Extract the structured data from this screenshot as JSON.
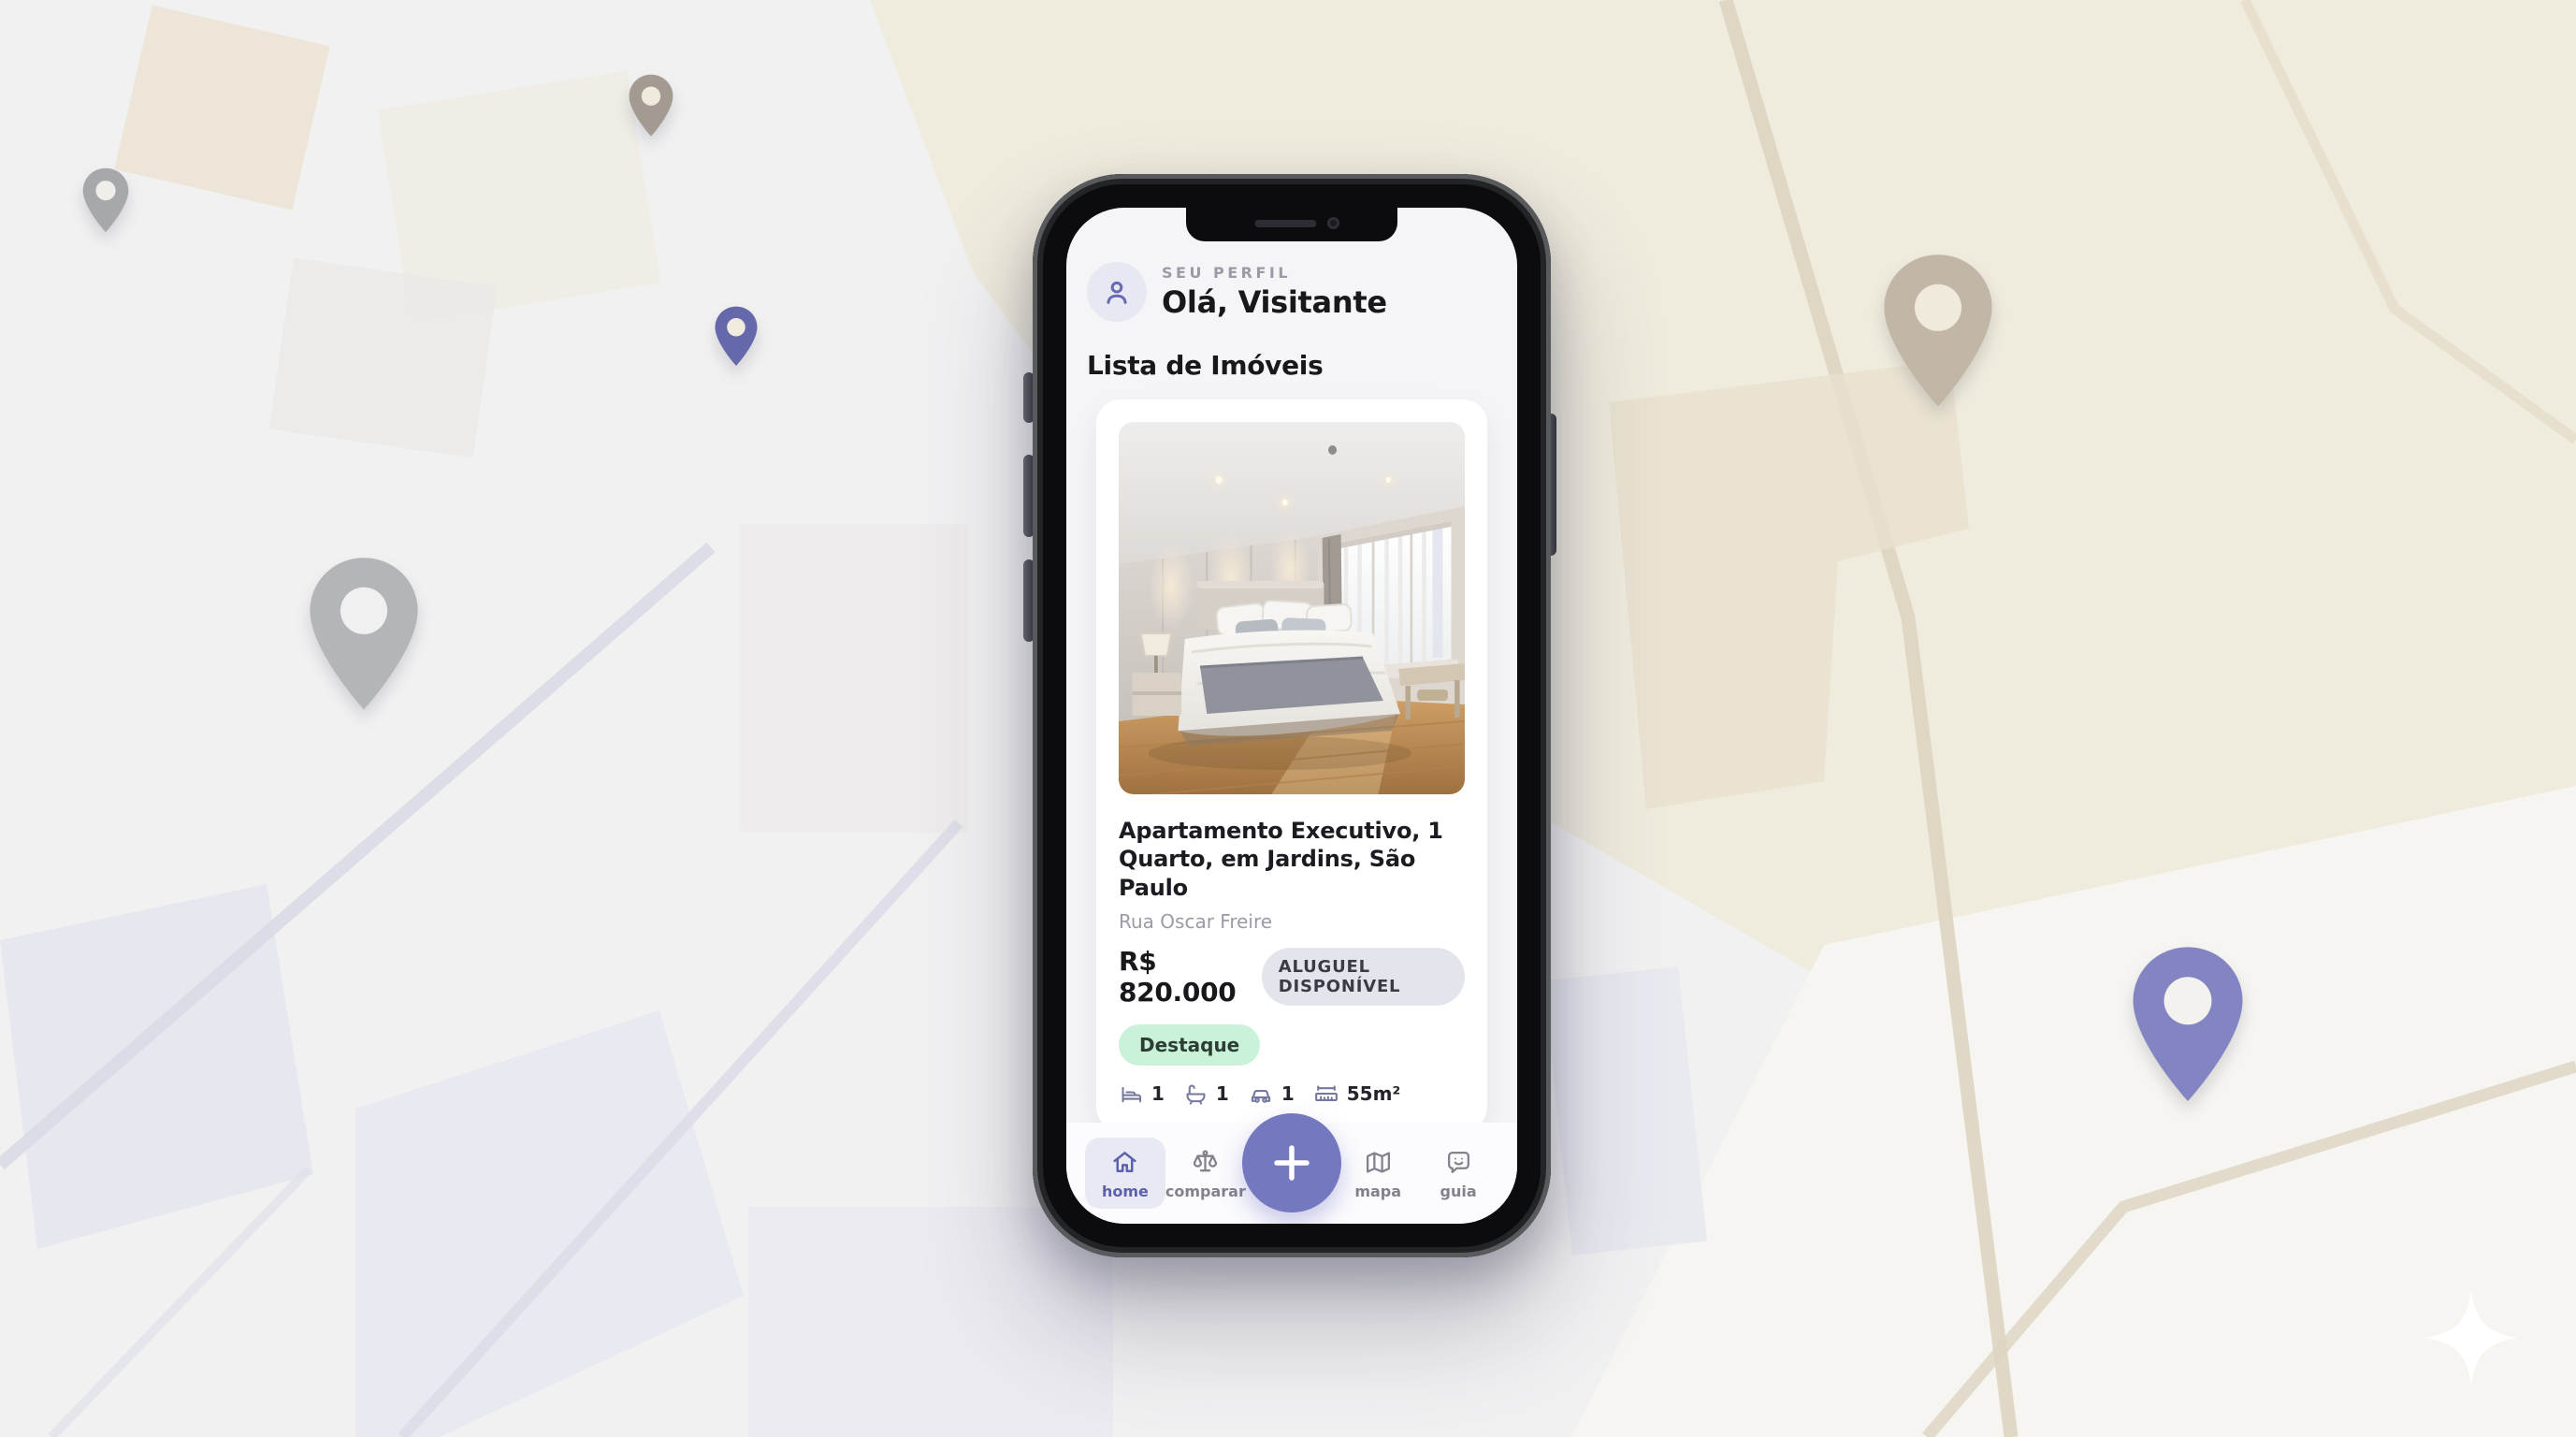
{
  "app": {
    "header": {
      "profile_label": "SEU PERFIL",
      "greeting": "Olá, Visitante"
    },
    "section_title": "Lista de Imóveis",
    "listing": {
      "title": "Apartamento Executivo, 1 Quarto, em Jardins, São Paulo",
      "address": "Rua Oscar Freire",
      "price": "R$ 820.000",
      "status_badge": "ALUGUEL DISPONÍVEL",
      "highlight_badge": "Destaque",
      "amenities": [
        {
          "icon": "bed-icon",
          "value": "1"
        },
        {
          "icon": "bath-icon",
          "value": "1"
        },
        {
          "icon": "car-icon",
          "value": "1"
        },
        {
          "icon": "ruler-icon",
          "value": "55m²"
        }
      ]
    },
    "nav": [
      {
        "label": "home",
        "icon": "home-icon",
        "active": true
      },
      {
        "label": "comparar",
        "icon": "scales-icon",
        "active": false
      },
      {
        "label": "mapa",
        "icon": "map-icon",
        "active": false
      },
      {
        "label": "guia",
        "icon": "chat-guide-icon",
        "active": false
      }
    ],
    "fab_icon": "plus-icon"
  },
  "colors": {
    "accent_purple": "#5d61ab",
    "fab_purple": "#7478bf",
    "status_badge_bg": "#e4e4ed",
    "highlight_badge_bg": "#c9f2d9",
    "screen_bg": "#f5f5f8",
    "pin_purple_large": "#8385c3",
    "pin_purple_small": "#6568ab",
    "pin_tan": "#c2b7a6",
    "pin_gray": "#b3b5b9",
    "map_cream": "#efebdd"
  }
}
